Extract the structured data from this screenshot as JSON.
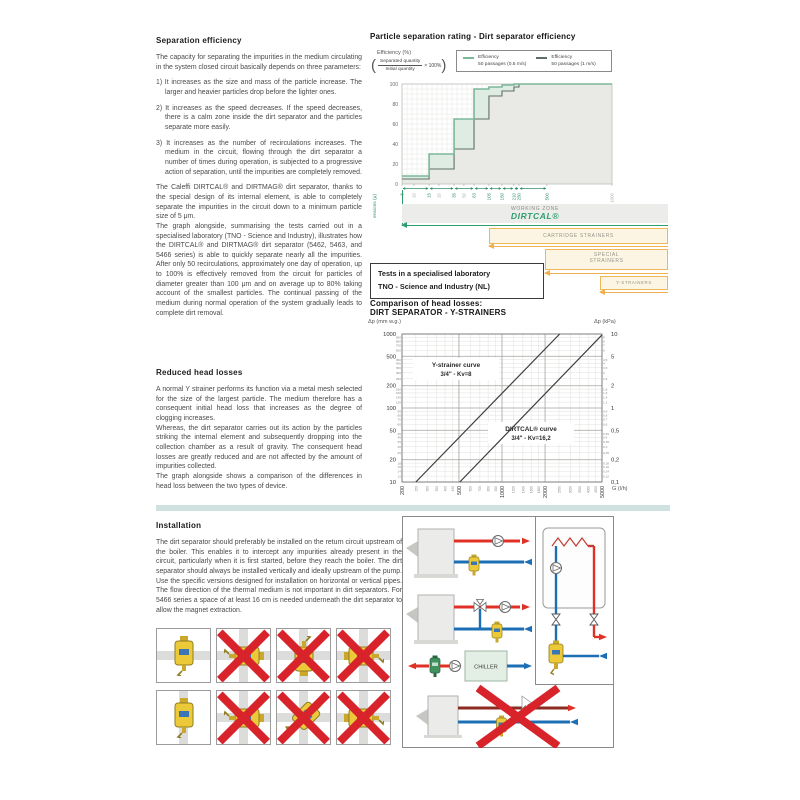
{
  "doc": {
    "separation": {
      "heading": "Separation efficiency",
      "intro": "The capacity for separating the impurities in the medium circulating in the system closed circuit basically depends on three parameters:",
      "items": [
        "1) It increases as the size and mass of the particle increase. The larger and heavier particles drop before the lighter ones.",
        "2) It increases as the speed decreases. If the speed decreases, there is a calm zone inside the dirt separator and the particles separate more easily.",
        "3) It increases as the number of recirculations increases. The medium in the circuit, flowing through the dirt separator a number of times during operation, is subjected to a progressive action of separation, until the impurities are completely removed."
      ],
      "p2": "The Caleffi DIRTCAL® and DIRTMAG® dirt separator, thanks to the special design of its internal element, is able to completely separate the impurities in the circuit down to a minimum particle size of 5 μm.",
      "p3": "The graph alongside, summarising the tests carried out in a specialised laboratory (TNO - Science and Industry), illustrates how the DIRTCAL® and DIRTMAG® dirt separator (5462, 5463, and 5466 series) is able to quickly separate nearly all the impurities. After only 50 recirculations, approximately one day of operation, up to 100% is effectively removed from the circuit for particles of diameter greater than 100 μm and on average up to 80% taking account of the smallest particles. The continual passing of the medium during normal operation of the system gradually leads to complete dirt removal."
    },
    "reduced": {
      "heading": "Reduced head losses",
      "p1": "A normal Y strainer performs its function via a metal mesh selected for the size of the largest particle. The medium therefore has a consequent initial head loss that increases as the degree of clogging increases.",
      "p2": "Whereas, the dirt separator carries out its action by the particles striking the internal element and subsequently dropping into the collection chamber as a result of gravity. The consequent head losses are greatly reduced and are not affected by the amount of impurities collected.",
      "p3": "The graph alongside shows a comparison of the differences in head loss between the two types of device."
    },
    "installation": {
      "heading": "Installation",
      "p1": "The dirt separator should preferably be installed on the return circuit upstream of the boiler. This enables it to intercept any impurities already present in the circuit, particularly when it is first started, before they reach the boiler. The dirt separator should always be installed vertically and ideally upstream of the pump. Use the specific versions designed for installation on horizontal or vertical pipes. The flow direction of the thermal medium is not important in dirt separators. For 5466 series a space of at least 16 cm is needed underneath the dirt separator to allow the magnet extraction."
    }
  },
  "test_box": {
    "line1": "Tests in a specialised laboratory",
    "line2": "TNO - Science and Industry (NL)"
  },
  "zones": {
    "working_label": "WORKING ZONE",
    "working_logo": "DIRTCAL®",
    "cartridge": "CARTRIDGE STRAINERS",
    "special_l1": "SPECIAL",
    "special_l2": "STRAINERS",
    "y_strainers": "Y-STRAINERS"
  },
  "diagram": {
    "chiller_label": "CHILLER"
  },
  "installation_figures": {
    "cells": [
      {
        "pipes": "h",
        "rotation": 0,
        "crossed": false
      },
      {
        "pipes": "cross",
        "rotation": 90,
        "crossed": true
      },
      {
        "pipes": "cross",
        "rotation": 180,
        "crossed": true
      },
      {
        "pipes": "cross",
        "rotation": 270,
        "crossed": true
      },
      {
        "pipes": "v",
        "rotation": 0,
        "crossed": false
      },
      {
        "pipes": "cross",
        "rotation": 90,
        "crossed": true
      },
      {
        "pipes": "cross",
        "rotation": 45,
        "crossed": true
      },
      {
        "pipes": "cross",
        "rotation": 270,
        "crossed": true
      }
    ]
  },
  "chart_data": [
    {
      "type": "area",
      "title": "Particle separation rating - Dirt separator efficiency",
      "ylabel": "Efficiency (%)",
      "formula": {
        "numerator": "Separated quantity",
        "denominator": "Initial quantity",
        "suffix": "× 100%"
      },
      "xlabel": "Particle dimensions (μ)",
      "ylim": [
        0,
        100
      ],
      "y_ticks": [
        0,
        20,
        40,
        60,
        80,
        100
      ],
      "x_ticks": [
        {
          "label": "5",
          "frac": 0.0,
          "major": true
        },
        {
          "label": "10",
          "frac": 0.057,
          "major": false
        },
        {
          "label": "15",
          "frac": 0.129,
          "major": true
        },
        {
          "label": "20",
          "frac": 0.176,
          "major": false
        },
        {
          "label": "35",
          "frac": 0.248,
          "major": true
        },
        {
          "label": "50",
          "frac": 0.295,
          "major": false
        },
        {
          "label": "63",
          "frac": 0.343,
          "major": true
        },
        {
          "label": "105",
          "frac": 0.414,
          "major": true
        },
        {
          "label": "150",
          "frac": 0.476,
          "major": true
        },
        {
          "label": "210",
          "frac": 0.533,
          "major": true
        },
        {
          "label": "250",
          "frac": 0.557,
          "major": true
        },
        {
          "label": "500",
          "frac": 0.69,
          "major": true
        },
        {
          "label": "1000",
          "frac": 1.0,
          "major": false
        }
      ],
      "series": [
        {
          "name": "Efficiency 50 passages (0.5 m/s)",
          "color": "#7cb79a",
          "fill": "#dfece4",
          "steps": [
            [
              5,
              15,
              8
            ],
            [
              15,
              35,
              30
            ],
            [
              35,
              63,
              65
            ],
            [
              63,
              105,
              95
            ],
            [
              105,
              150,
              97
            ],
            [
              150,
              210,
              99
            ],
            [
              210,
              1000,
              100
            ]
          ]
        },
        {
          "name": "Efficiency 50 passages (1 m/s)",
          "color": "#5f6f66",
          "fill": "#e9e9e6",
          "steps": [
            [
              5,
              15,
              5
            ],
            [
              15,
              35,
              15
            ],
            [
              35,
              63,
              35
            ],
            [
              63,
              105,
              65
            ],
            [
              105,
              150,
              88
            ],
            [
              150,
              210,
              93
            ],
            [
              210,
              250,
              97
            ],
            [
              250,
              1000,
              100
            ]
          ]
        }
      ],
      "legend": [
        {
          "line1": "Efficiency",
          "line2": "50 passages (0.5 m/s)",
          "color": "#7cb79a"
        },
        {
          "line1": "Efficiency",
          "line2": "50 passages (1 m/s)",
          "color": "#5f6f66"
        }
      ]
    },
    {
      "type": "line",
      "title1": "Comparison of head losses:",
      "title2": "DIRT SEPARATOR - Y-STRAINERS",
      "ylabel_left": "Δp (mm w.g.)",
      "ylabel_right": "Δp (kPa)",
      "xlabel": "G (l/h)",
      "xlim": [
        200,
        5000
      ],
      "ylim_mm": [
        10,
        1000
      ],
      "x_ticks": [
        200,
        500,
        1000,
        2000,
        5000
      ],
      "x_minor": [
        250,
        300,
        350,
        400,
        450,
        600,
        700,
        800,
        900,
        1200,
        1400,
        1600,
        1800,
        2500,
        3000,
        3500,
        4000,
        4500
      ],
      "y_ticks_mm": [
        1000,
        500,
        200,
        100,
        50,
        20,
        10
      ],
      "y_minor_mm": [
        900,
        800,
        700,
        600,
        450,
        400,
        350,
        300,
        250,
        180,
        160,
        140,
        120,
        90,
        80,
        70,
        60,
        45,
        40,
        35,
        30,
        25,
        18,
        16,
        14,
        12
      ],
      "y_ticks_kpa": [
        "10",
        "5",
        "2",
        "1",
        "0,5",
        "0,2",
        "0,1"
      ],
      "y_minor_kpa": [
        "9",
        "8",
        "7",
        "6",
        "4,5",
        "4",
        "3,5",
        "3",
        "2,5",
        "1,8",
        "1,6",
        "1,4",
        "1,2",
        "0,9",
        "0,8",
        "0,7",
        "0,6",
        "0,45",
        "0,4",
        "0,35",
        "0,3",
        "0,25",
        "0,18",
        "0,16",
        "0,14",
        "0,12"
      ],
      "series": [
        {
          "name": "Y-strainer curve 3/4\" - Kv=8",
          "label_line1": "Y-strainer curve",
          "label_line2": "3/4\" - Kv=8",
          "points": [
            [
              250,
              10
            ],
            [
              2530,
              1000
            ]
          ]
        },
        {
          "name": "DIRTCAL® curve 3/4\" - Kv=16,2",
          "label_line1": "DIRTCAL® curve",
          "label_line2": "3/4\" - Kv=16,2",
          "points": [
            [
              507,
              10
            ],
            [
              5000,
              971
            ]
          ]
        }
      ]
    }
  ]
}
